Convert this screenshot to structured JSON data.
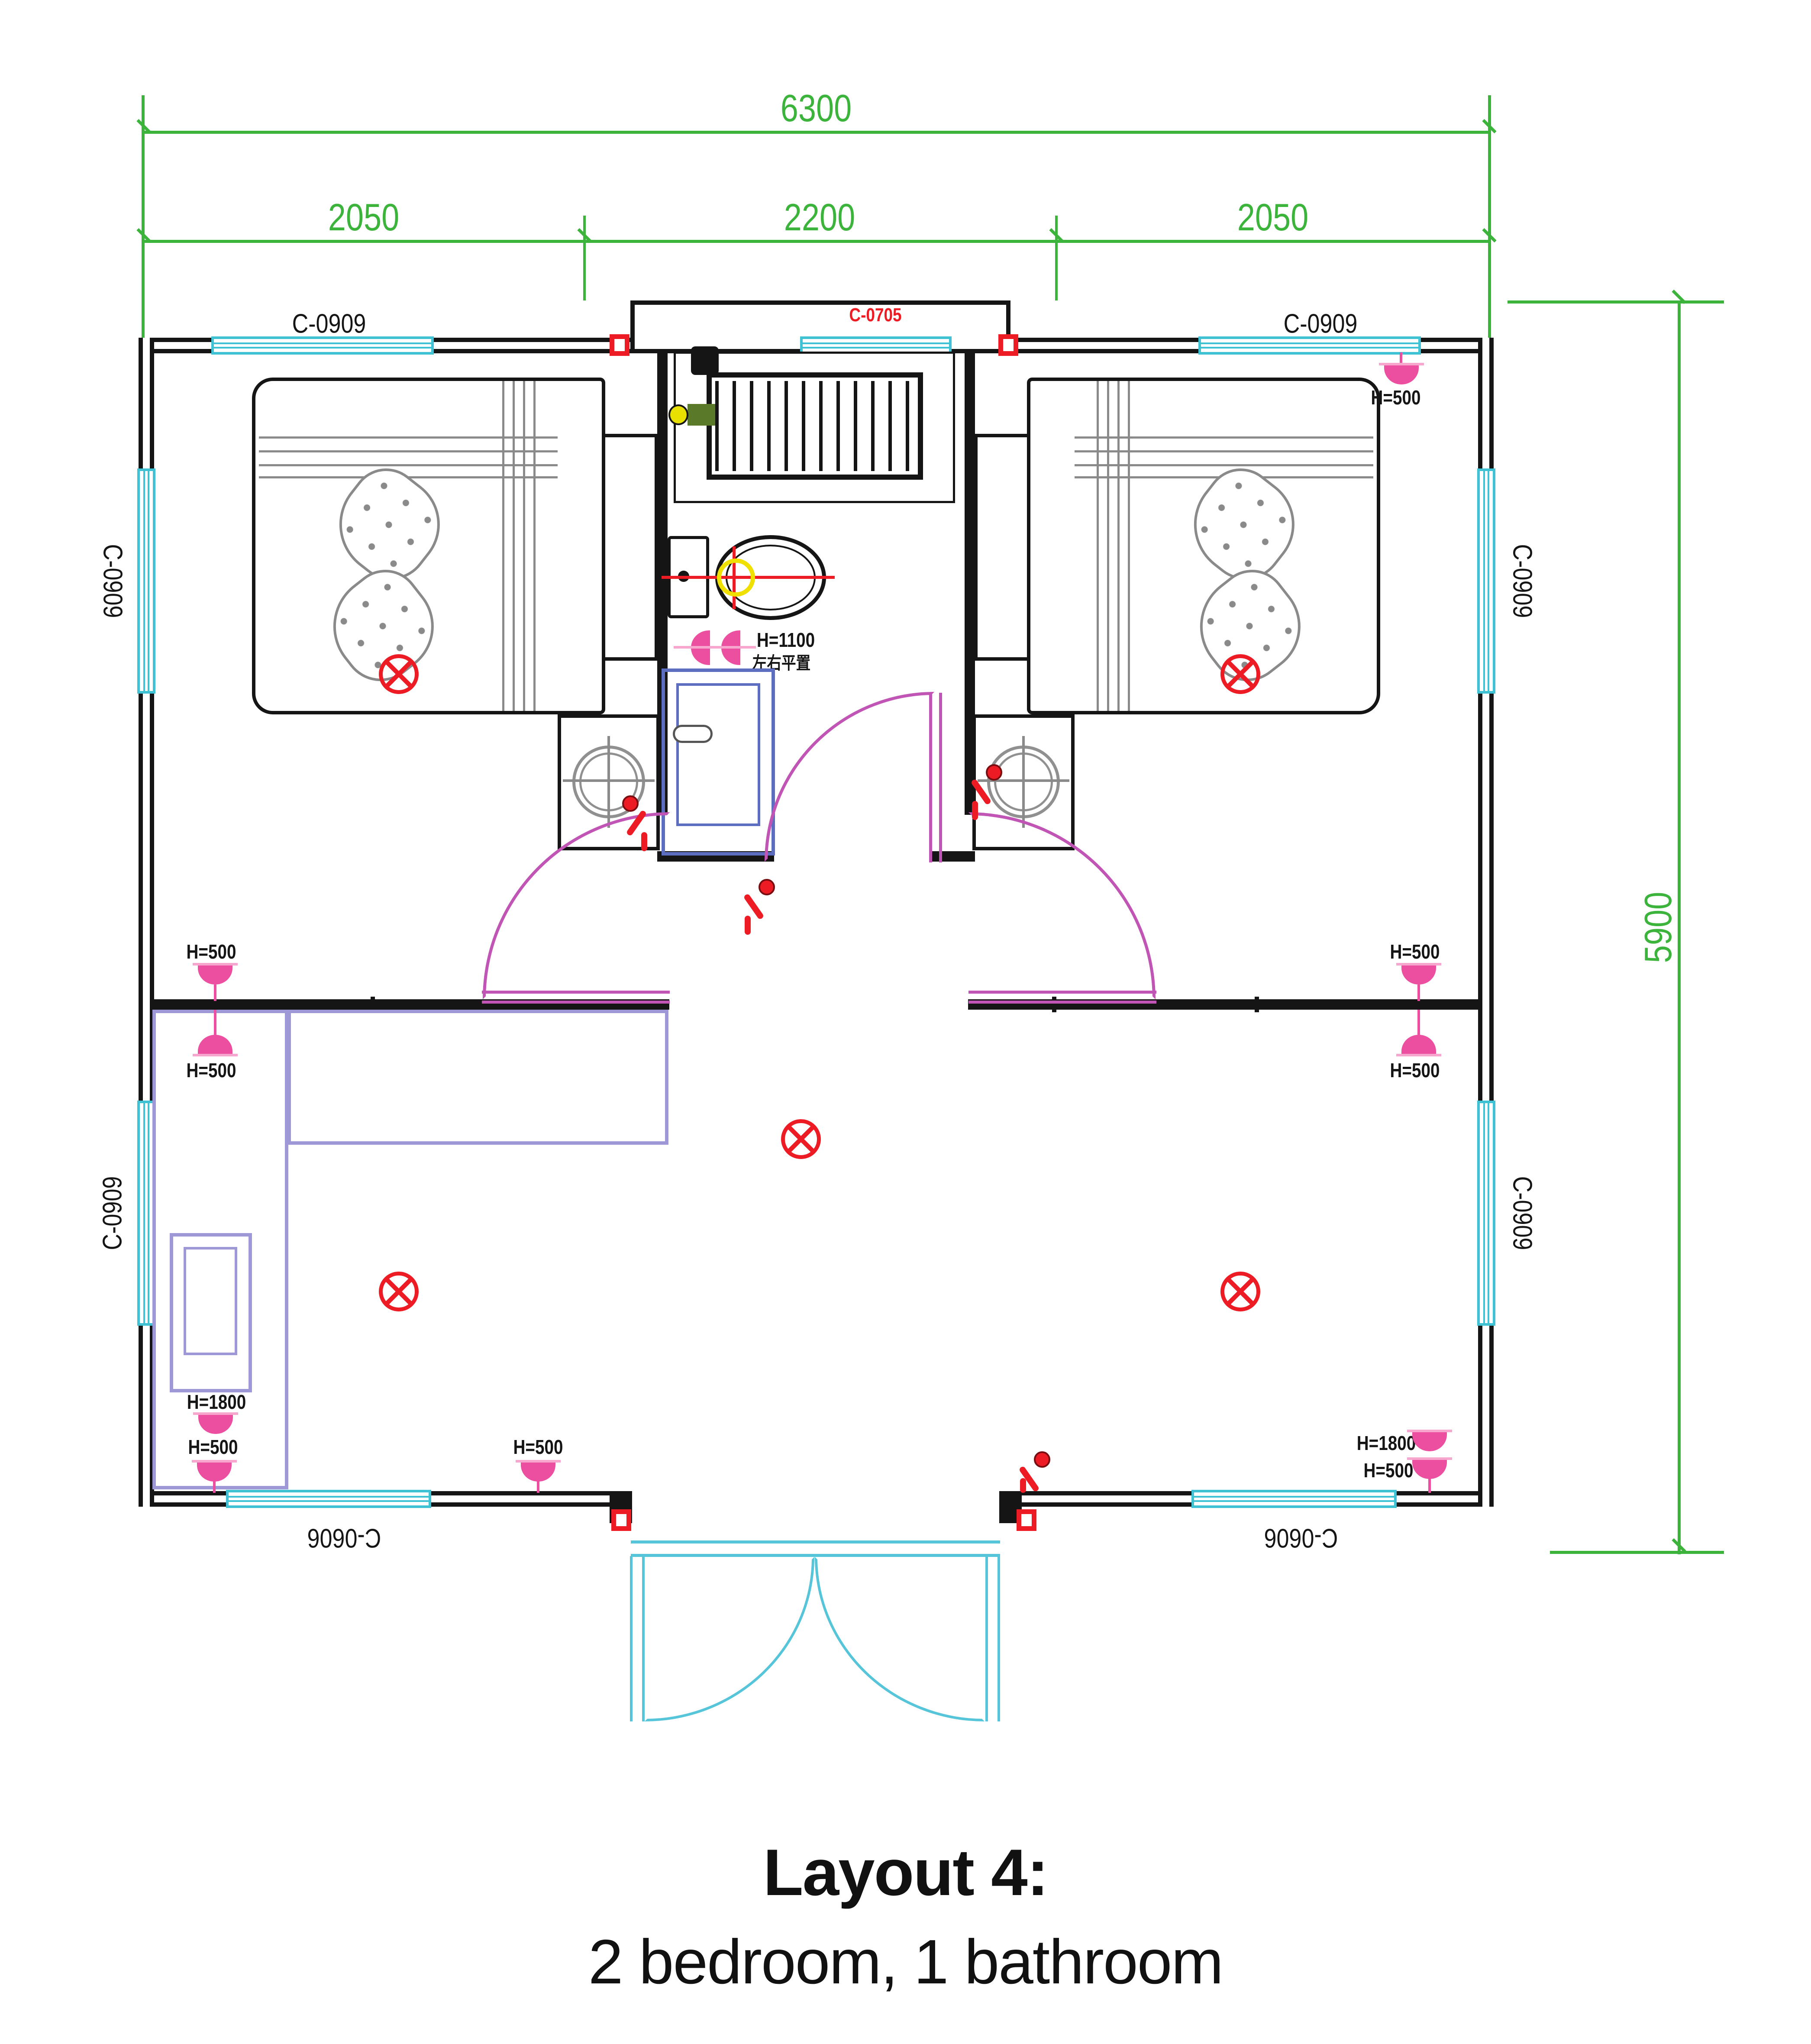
{
  "title": "Layout 4:",
  "subtitle": "2 bedroom, 1 bathroom",
  "dimensions": {
    "overall_width": "6300",
    "width_segments": [
      "2050",
      "2200",
      "2050"
    ],
    "overall_height": "5900"
  },
  "window_labels": {
    "top_left": "C-0909",
    "top_center": "C-0705",
    "top_right": "C-0909",
    "left_upper": "C-0909",
    "left_lower": "C-0909",
    "right_upper": "C-0909",
    "right_lower": "C-0909",
    "bottom_left": "C-0606",
    "bottom_right": "C-0606"
  },
  "height_labels": {
    "bathroom_lamp": "H=1100",
    "bathroom_lamp_note": "左右平置",
    "bedroom_right_lamp": "H=500",
    "left_wall_upper": "H=500",
    "left_wall_lower": "H=500",
    "right_wall_upper": "H=500",
    "right_wall_lower": "H=500",
    "bottom_left_tall": "H=1800",
    "bottom_left": "H=500",
    "bottom_center": "H=500",
    "bottom_right_tall": "H=1800",
    "bottom_right": "H=500"
  },
  "colors": {
    "dimension_green": "#3cb43c",
    "window_cyan": "#3fc3d4",
    "entry_door_cyan": "#56c5da",
    "door_magenta": "#c155b5",
    "lamp_pink": "#ec4fa0",
    "electric_red": "#ed1c24",
    "vanity_blue": "#5d6ec1",
    "furniture_purple": "#9e99d6",
    "wall_black": "#151515"
  }
}
